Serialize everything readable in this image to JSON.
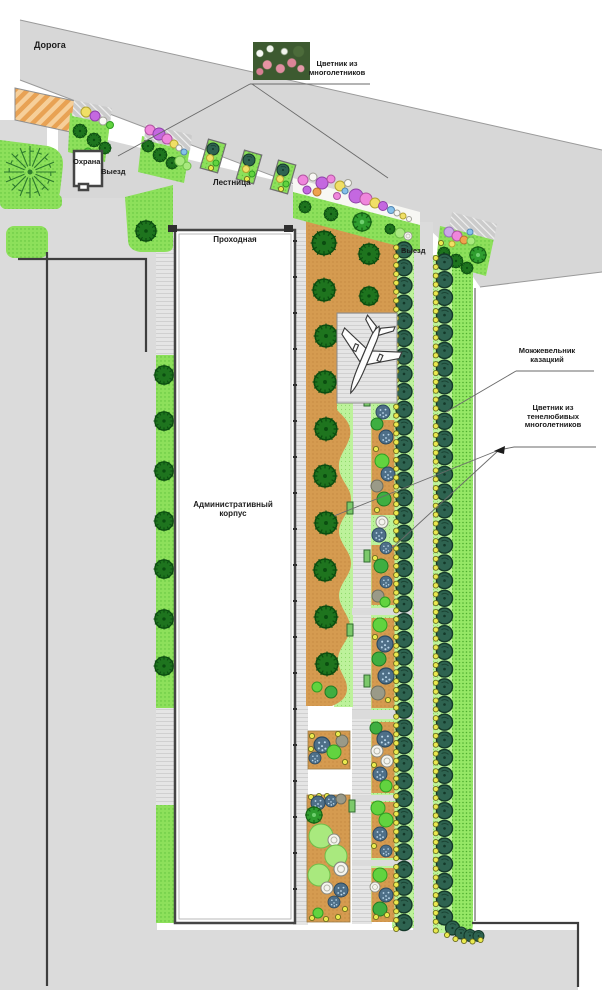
{
  "labels": {
    "road": "Дорога",
    "perennial_bed_caption": "Цветник из многолетников",
    "security_post": "Охрана",
    "exit_west": "Выезд",
    "stairs": "Лестница",
    "checkpoint": "Проходная",
    "exit_east": "Выезд",
    "admin_building": "Административный корпус",
    "juniper_caption": "Можжевельник казацкий",
    "shade_bed_caption": "Цветник из тенелюбивых многолетников"
  },
  "icons": {
    "airplane": "airplane-top-view-icon",
    "photo": "perennial-flowers-photo",
    "trees": "tree-canopy-icons",
    "juniper_rows": "juniper-row-icons"
  },
  "palette": {
    "page_bg": "#ffffff",
    "road_gray": "#d7d7d7",
    "pavement_gray": "#dbdbdb",
    "hatch_gray": "#e5e5e5",
    "hatch_line": "#d0d0d0",
    "shoulder_gray": "#cbcbcb",
    "shoulder_line": "#efefef",
    "lawn_green": "#8de05b",
    "lawn_dot": "#60c23c",
    "lawn2_green": "#96e866",
    "lawn2_dot": "#4fae2f",
    "light_green": "#bdf29b",
    "light_dot": "#8fd96b",
    "bed_orange": "#d59b50",
    "bed_orange_dot": "#c48941",
    "stripe_orange": "#e8a254",
    "stripe_orange_light": "#f6cf9a",
    "tree_dark": "#1e741e",
    "tree_dark_edge": "#0b4d10",
    "tree_teal": "#2e6350",
    "tree_teal_edge": "#143829",
    "ring_yellow": "#e9e94e",
    "ring_edge": "#6b6b1f",
    "flower_pink": "#ef86dc",
    "flower_violet": "#c468e0",
    "flower_yellow": "#f0df66",
    "flower_white": "#f8f8f4",
    "flower_orange": "#f0a24e",
    "flower_blue": "#85c1ea",
    "flower_lilac": "#cba6ea",
    "plant_bright": "#62d33f",
    "plant_mid": "#3fae41",
    "plant_gray": "#9a9a88",
    "plant_dotted": "#4e6f88",
    "plant_fluffy": "#a9e97e",
    "outline": "#3e3e3e",
    "building_fill": "#ffffff",
    "line_gray": "#9a9a9a"
  }
}
